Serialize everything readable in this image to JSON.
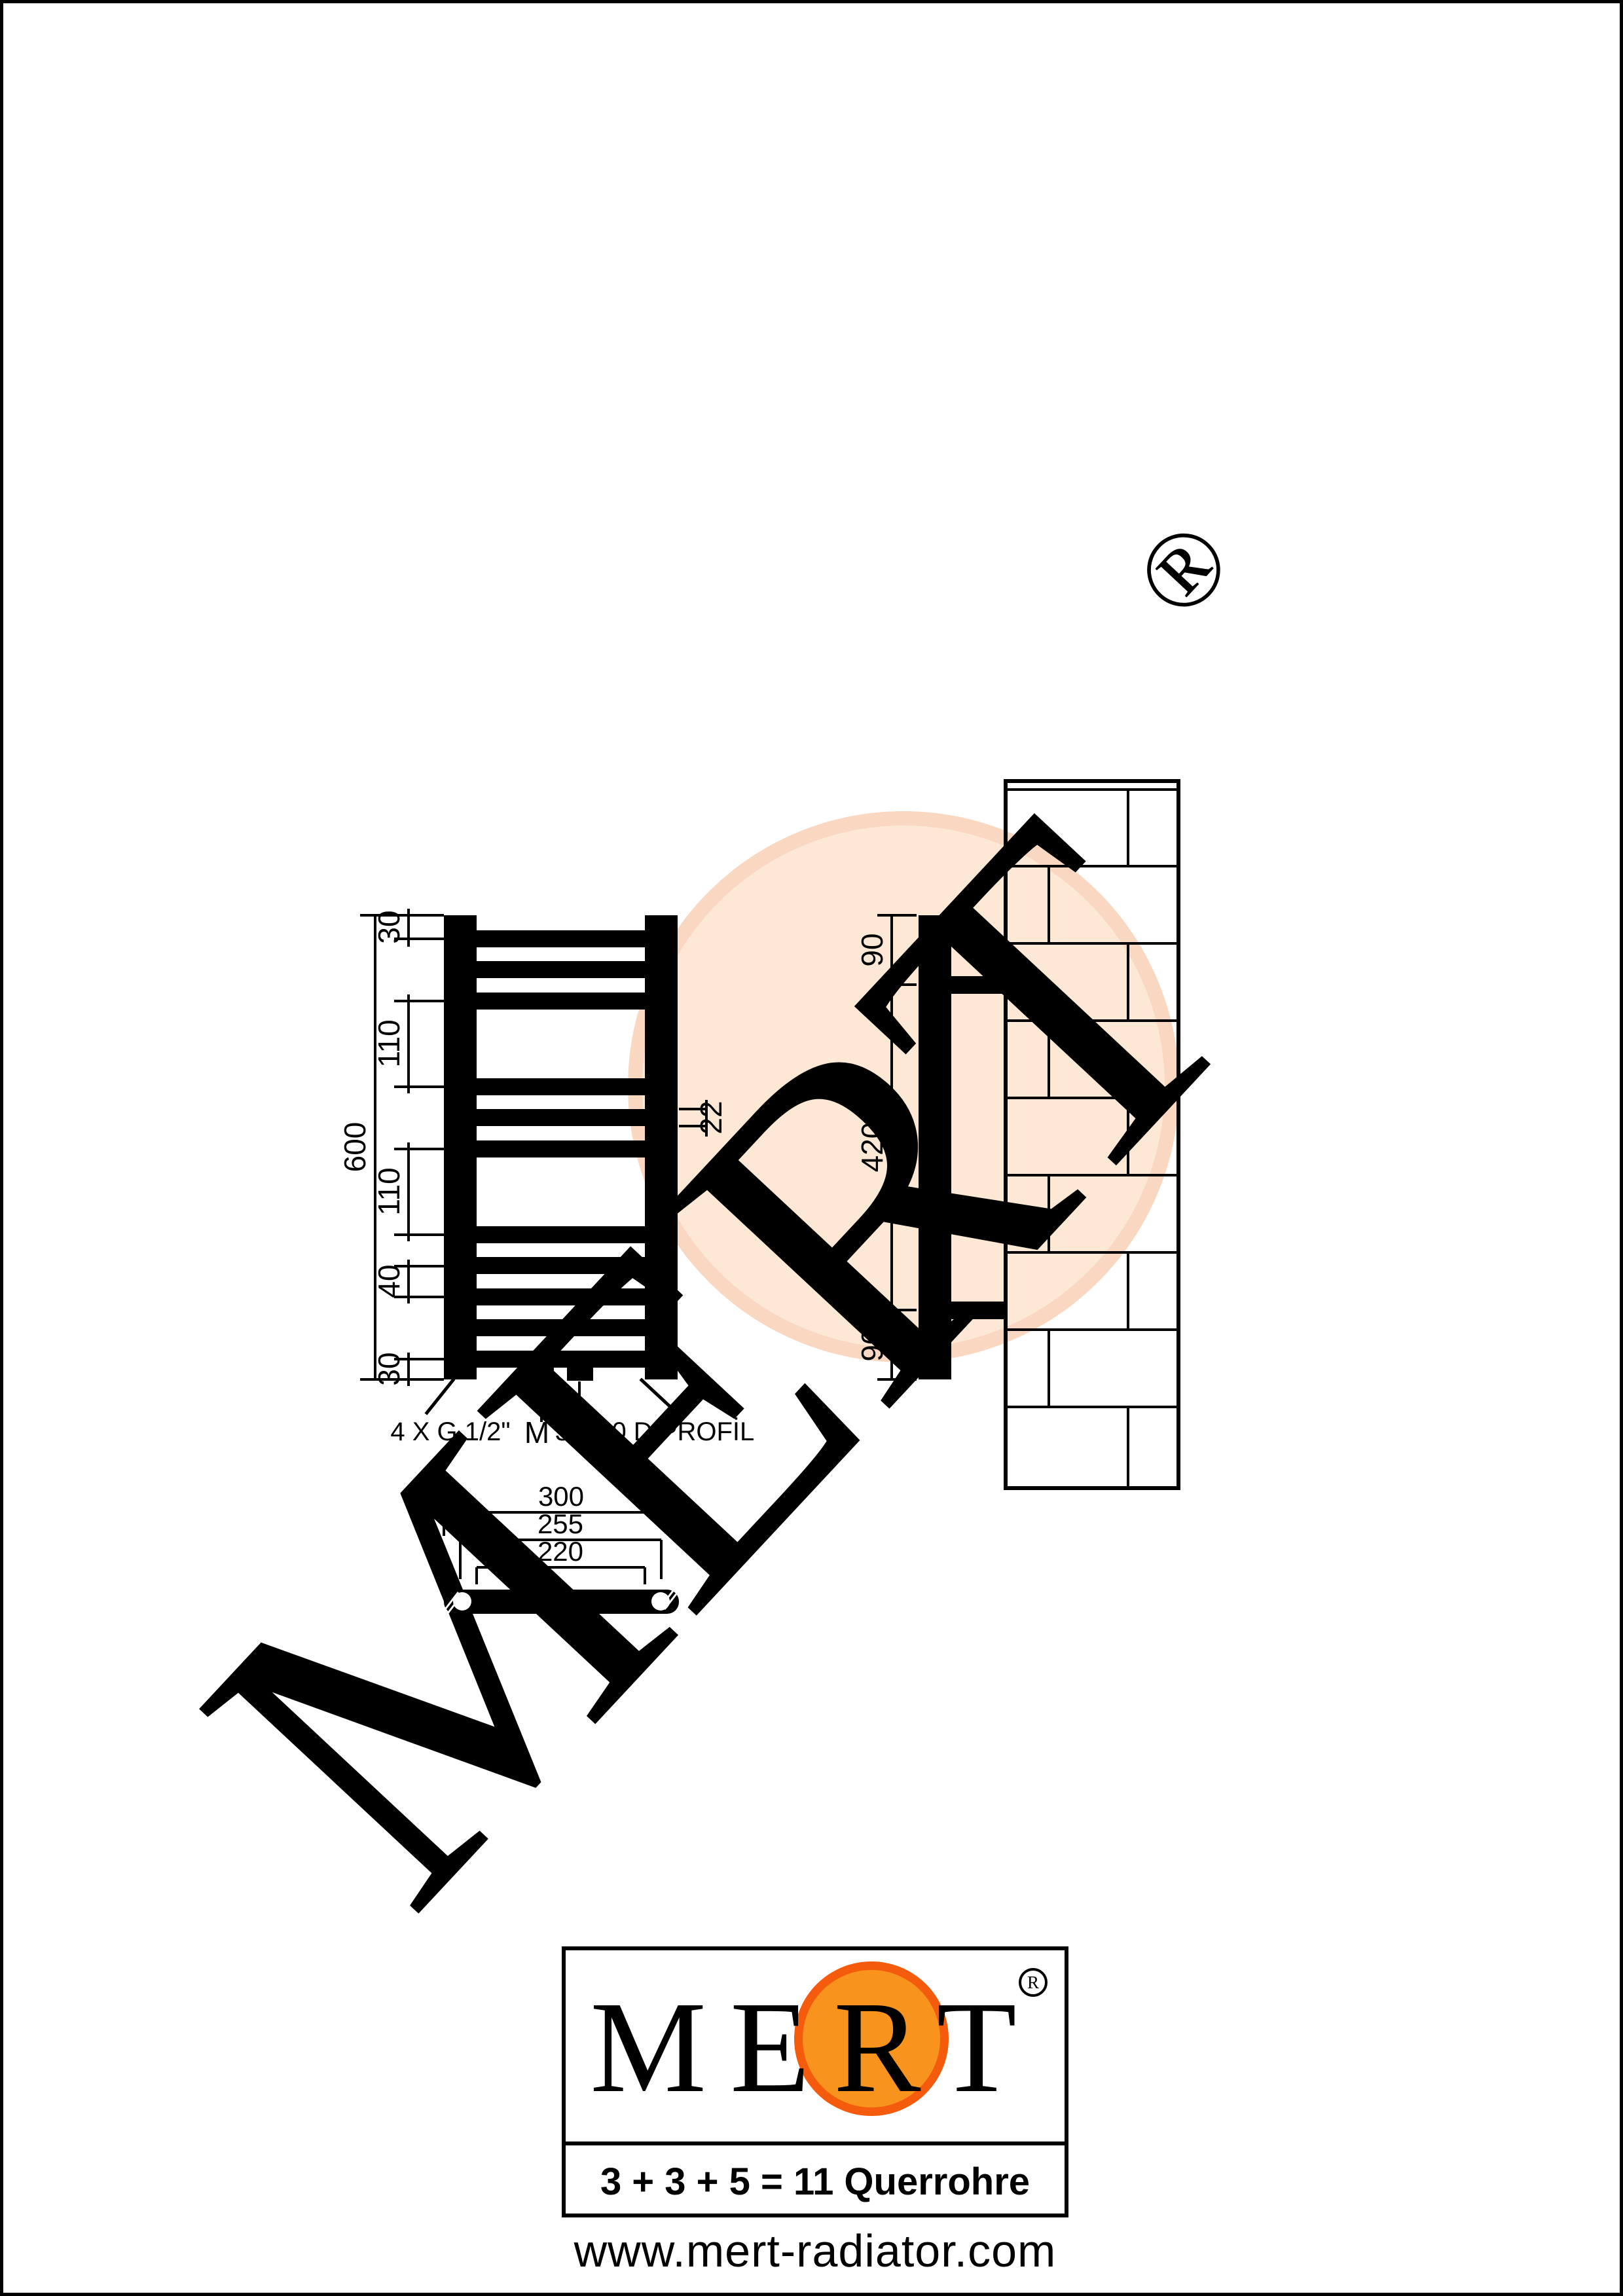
{
  "watermark": {
    "brand": "MERT",
    "registered": "®"
  },
  "front_view": {
    "dim_overall": "600",
    "dim_top": "30",
    "dim_gap1": "110",
    "dim_gap2": "110",
    "dim_pitch": "40",
    "dim_bottom": "30",
    "dim_tube": "22",
    "dim_connections": "50",
    "label_connections": "4 X G 1/2\"",
    "label_m": "M",
    "label_profile": "30x40 D PROFİL"
  },
  "side_view": {
    "dim_top": "90",
    "dim_mid": "420",
    "dim_bottom": "90"
  },
  "top_view": {
    "dim_outer": "300",
    "dim_centers": "255",
    "dim_inner": "220"
  },
  "logo": {
    "brand": "MERT",
    "registered": "R",
    "formula": "3 + 3 + 5 = 11 Querrohre",
    "website": "www.mert-radiator.com"
  },
  "colors": {
    "logo_orange": "#F8941E",
    "logo_orange_ring": "#F55B0D",
    "watermark_gray": "#D8DADC",
    "watermark_peach": "#FCE8D5",
    "watermark_peach_ring": "#F9D7C1",
    "line_black": "#000000"
  }
}
